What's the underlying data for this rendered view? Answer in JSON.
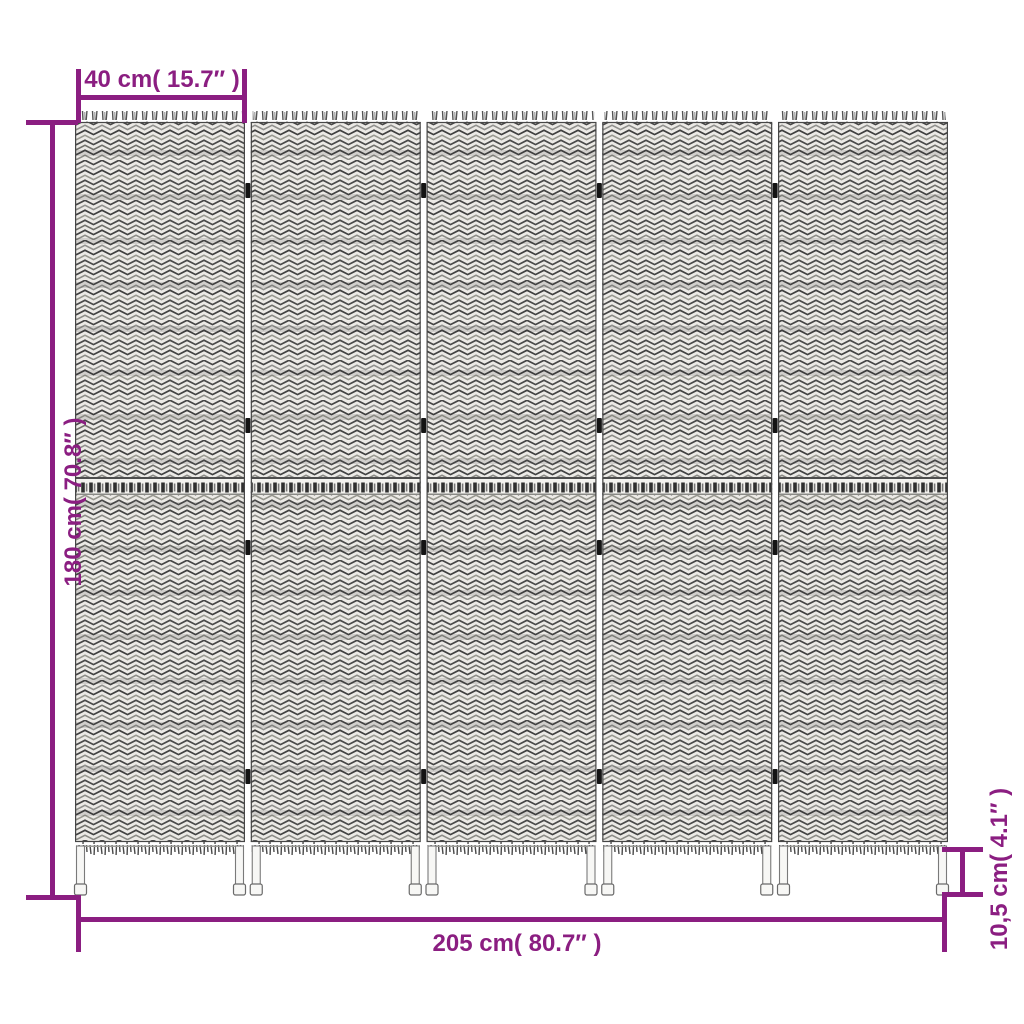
{
  "diagram": {
    "subject": "five-panel woven folding room divider, front view",
    "panel_count": 5,
    "hinge_rows": 4
  },
  "dimensions": {
    "panel_width": "40 cm( 15.7″ )",
    "height": "180 cm( 70.8″ )",
    "total_width": "205 cm( 80.7″ )",
    "leg_height": "10,5 cm( 4.1″ )"
  },
  "colors": {
    "dimension_accent": "#8B1E81",
    "panel_outline": "#464646",
    "weave_base": "#ECEAE6",
    "weave_dark": "#3F3F3F",
    "weave_light": "#8F8F8C",
    "hinge": "#141414",
    "leg_fill": "#F7F7F5",
    "background": "#FFFFFF"
  }
}
